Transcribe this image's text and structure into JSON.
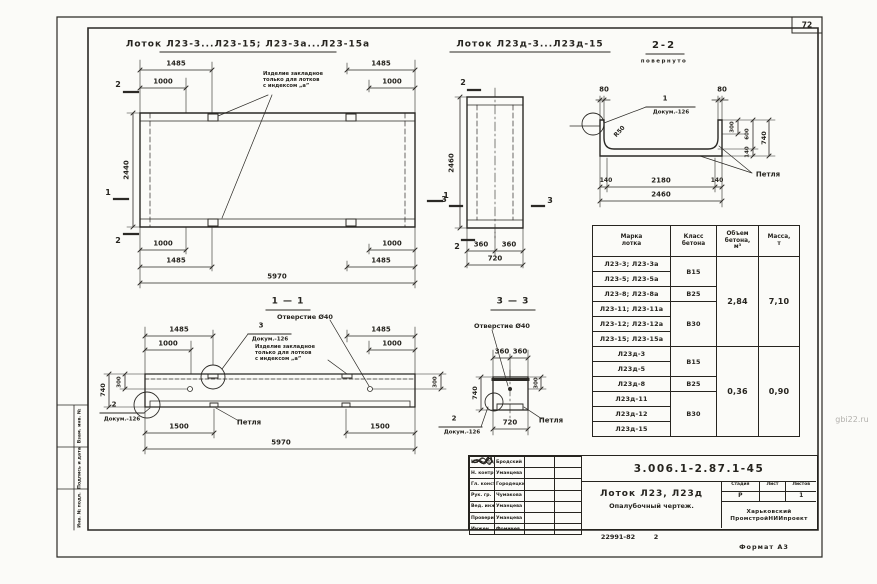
{
  "page": {
    "number": "72",
    "watermark": "gbi22.ru",
    "format_note": "Формат А3",
    "doc_small": "22991-82",
    "sheet_small": "2"
  },
  "titles": {
    "main_left": "Лоток Л23-3...Л23-15; Л23-3а...Л23-15а",
    "main_mid": "Лоток Л23д-3...Л23д-15",
    "section22": "2-2",
    "rotated": "повернуто",
    "section11": "1 — 1",
    "section33": "3 — 3"
  },
  "callouts": {
    "embedded": "Изделие закладное\nтолько для лотков\nс индексом „а”",
    "hole": "Отверстие Ø40",
    "dok": "Докум.-126",
    "n1": "1",
    "n2": "2",
    "n3": "3",
    "petlya": "Петля",
    "r50": "R50"
  },
  "plan": {
    "d1485": "1485",
    "d1000": "1000",
    "d5970": "5970",
    "d2440": "2440",
    "m1": "1",
    "m2": "2"
  },
  "end_view": {
    "d2460": "2460",
    "d360": "360",
    "d720": "720",
    "m2": "2",
    "m3": "3"
  },
  "sec22": {
    "d80": "80",
    "d300": "300",
    "d600": "600",
    "d140": "140",
    "d740": "740",
    "d2180": "2180",
    "d2460": "2460"
  },
  "sec11": {
    "d1485": "1485",
    "d1000": "1000",
    "d740": "740",
    "d300": "300",
    "d1500": "1500",
    "d5970": "5970"
  },
  "sec33": {
    "d360": "360",
    "d740": "740",
    "d300": "300",
    "d720": "720"
  },
  "table": {
    "h_mark": "Марка\nлотка",
    "h_class": "Класс\nбетона",
    "h_vol": "Объем\nбетона,\nм³",
    "h_mass": "Масса,\nт",
    "marks": [
      "Л23-3; Л23-3а",
      "Л23-5; Л23-5а",
      "Л23-8; Л23-8а",
      "Л23-11; Л23-11а",
      "Л23-12; Л23-12а",
      "Л23-15; Л23-15а",
      "Л23д-3",
      "Л23д-5",
      "Л23д-8",
      "Л23д-11",
      "Л23д-12",
      "Л23д-15"
    ],
    "c1": "В15",
    "c2": "В25",
    "c3": "В30",
    "c4": "В15",
    "c5": "В25",
    "c6": "В30",
    "vol1": "2,84",
    "mass1": "7,10",
    "vol2": "0,36",
    "mass2": "0,90"
  },
  "titleblock": {
    "doc": "3.006.1-2.87.1-45",
    "title1": "Лоток Л23, Л23д",
    "title2": "Опалубочный чертеж.",
    "stage_h": "Стадия",
    "sheet_h": "Лист",
    "sheets_h": "Листов",
    "stage": "Р",
    "sheet": "",
    "sheets": "1",
    "org": "Харьковский\nПромстройНИИпроект",
    "roles": [
      "Нач. отд",
      "Н. контр",
      "Гл. конст",
      "Рук. гр.",
      "Вед. инж",
      "Проверил",
      "Инжен"
    ],
    "names": [
      "Бродский",
      "Уманцева",
      "Городецкий",
      "Чумакова",
      "Уманцева",
      "Уманцева",
      "Фомичев"
    ]
  },
  "margin": {
    "l1": "Взам. инв. №",
    "l2": "Подпись и дата",
    "l3": "Инв. № подл."
  }
}
